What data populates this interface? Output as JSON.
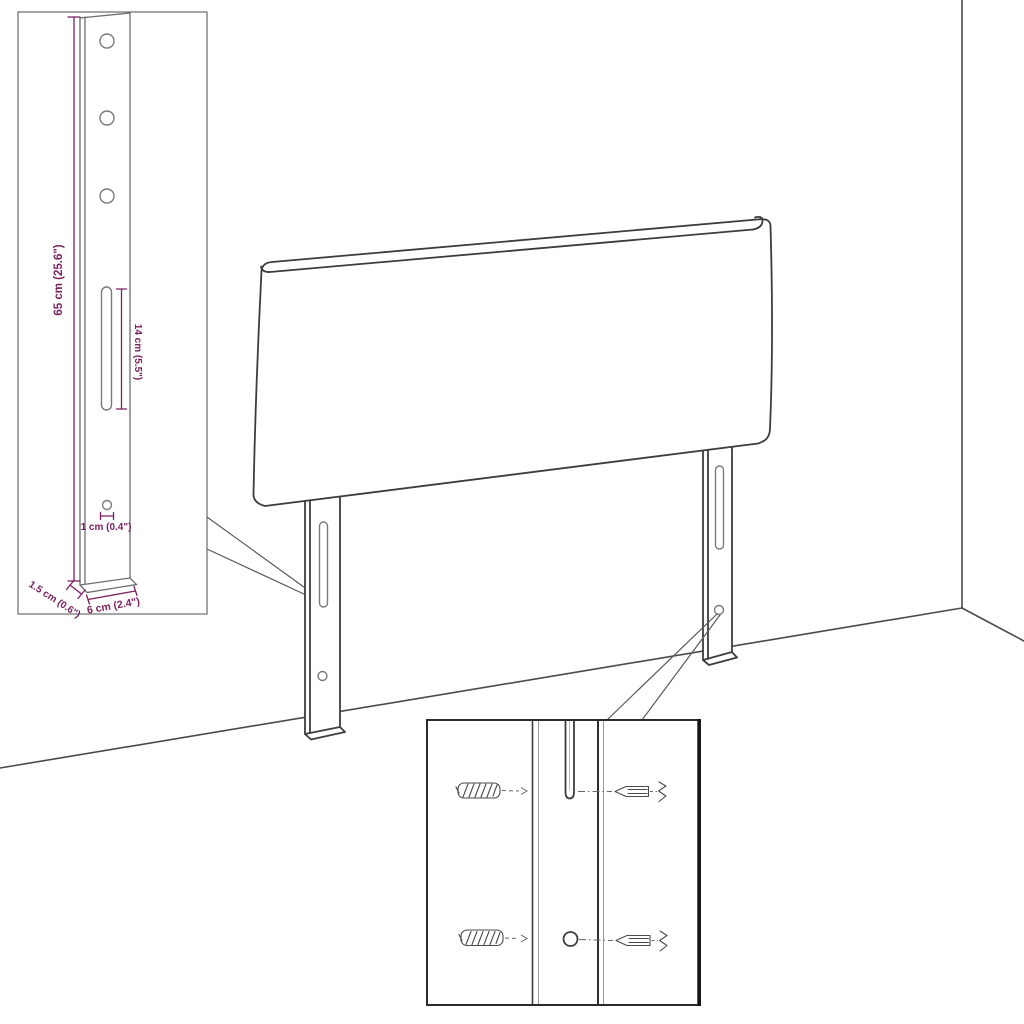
{
  "inset_dimensions": {
    "height": "65 cm (25.6\")",
    "slot_length": "14 cm (5.5\")",
    "hole_offset": "1 cm (0.4\")",
    "depth": "1.5 cm (0.6\")",
    "width": "6 cm (2.4\")"
  },
  "colors": {
    "dimension_text": "#7b2160",
    "line_art": "#3d3d3d",
    "background": "#ffffff"
  }
}
